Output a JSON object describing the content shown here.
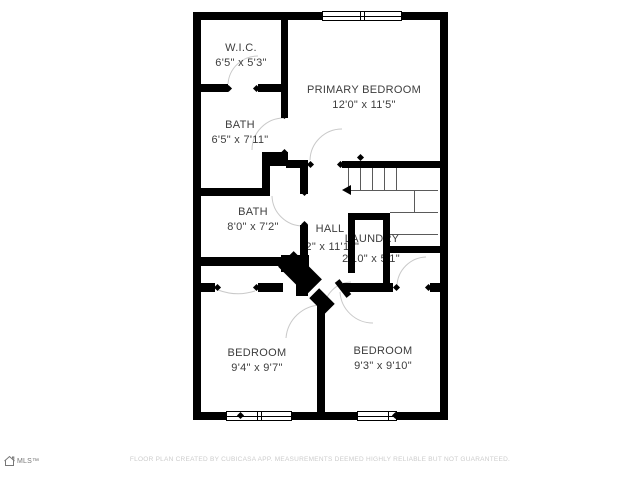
{
  "plan": {
    "rooms": [
      {
        "name": "W.I.C.",
        "dims": "6'5\" x 5'3\""
      },
      {
        "name": "PRIMARY BEDROOM",
        "dims": "12'0\" x 11'5\""
      },
      {
        "name": "BATH",
        "dims": "6'5\" x 7'11\""
      },
      {
        "name": "BATH",
        "dims": "8'0\" x 7'2\""
      },
      {
        "name": "HALL",
        "dims": "'2\" x 11'11\""
      },
      {
        "name": "LAUNDRY",
        "dims": "2'10\" x 5'1\""
      },
      {
        "name": "BEDROOM",
        "dims": "9'4\" x 9'7\""
      },
      {
        "name": "BEDROOM",
        "dims": "9'3\" x 9'10\""
      }
    ],
    "stairs": {
      "direction_arrow": "left"
    },
    "colors": {
      "wall": "#000000",
      "room_label": "#3d3d3d",
      "stair_line": "#5a5a5a",
      "door_arc": "#c9c9c9",
      "footer_text": "#cccccc"
    }
  },
  "footer": {
    "disclaimer": "FLOOR PLAN CREATED BY CUBICASA APP. MEASUREMENTS DEEMED HIGHLY RELIABLE BUT NOT GUARANTEED."
  },
  "logo": {
    "text": "MLS™"
  }
}
